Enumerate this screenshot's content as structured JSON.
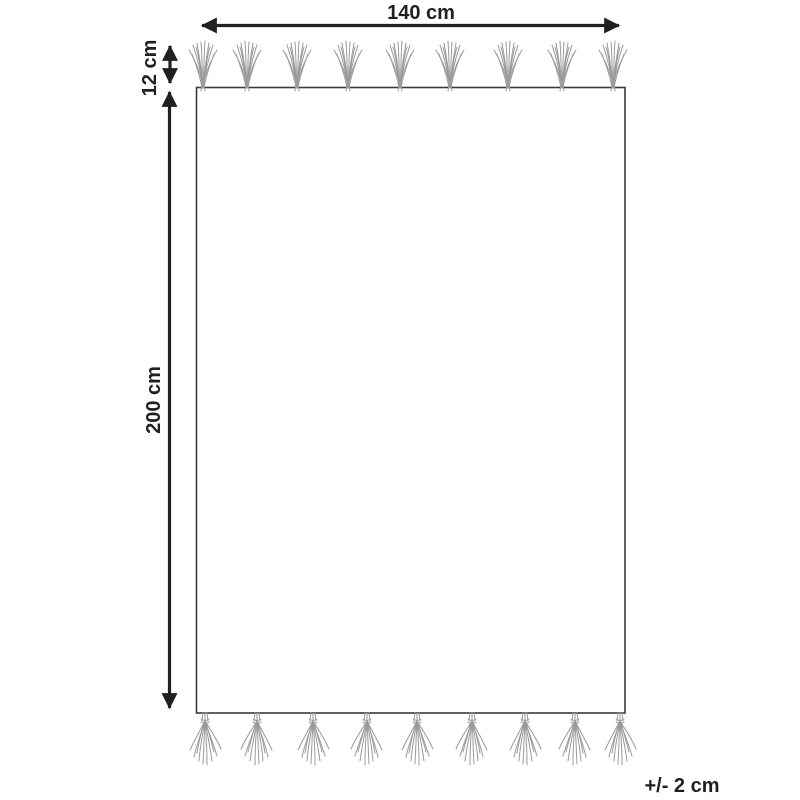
{
  "diagram": {
    "type": "rug-dimension-drawing",
    "labels": {
      "width": "140 cm",
      "length": "200 cm",
      "fringe": "12 cm",
      "tolerance": "+/- 2 cm"
    },
    "tassels": {
      "top_count": 9,
      "bottom_count": 9
    }
  },
  "colors": {
    "dimension_lines": "#231f20",
    "rug_outline": "#3a3a3a",
    "tassel": "#9a9a9a",
    "background": "#ffffff"
  }
}
